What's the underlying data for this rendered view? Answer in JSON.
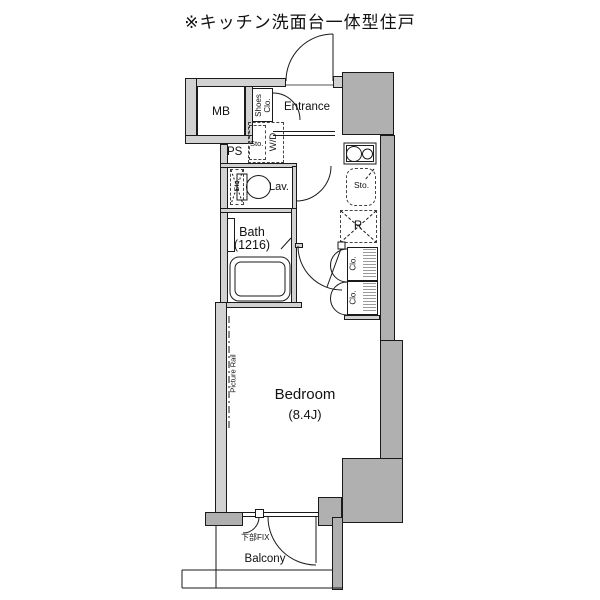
{
  "title": "※キッチン洗面台一体型住戸",
  "labels": {
    "mb": "MB",
    "shoes_closet": "Shoes Clo.",
    "entrance": "Entrance",
    "ps": "PS",
    "wd_storage": "Sto.",
    "washer_dryer": "W/D",
    "lav_storage": "Sto.",
    "lavatory": "Lav.",
    "bath": "Bath",
    "bath_size": "(1216)",
    "kitchen_storage": "Sto.",
    "refrigerator": "R",
    "closet_upper": "Clo.",
    "closet_lower": "Clo.",
    "picture_rail": "Picture Rail",
    "bedroom": "Bedroom",
    "bedroom_size": "(8.4J)",
    "lower_fix_window": "下部FIX",
    "balcony": "Balcony"
  },
  "colors": {
    "background": "#ffffff",
    "wall_light": "#d2d2d2",
    "wall_dark": "#b0b0b0",
    "line": "#1a1a1a"
  }
}
